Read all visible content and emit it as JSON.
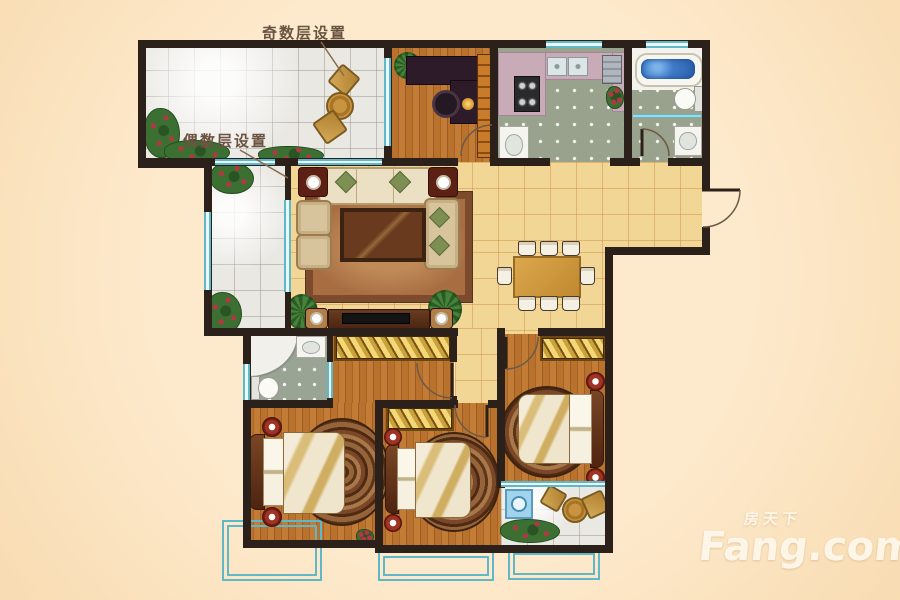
{
  "document": {
    "kind": "apartment-floor-plan",
    "width": 900,
    "height": 600
  },
  "annotations": {
    "odd_floor_note": "奇数层设置",
    "even_floor_note": "偶数层设置"
  },
  "watermark": {
    "brand_cn": "房天下",
    "brand_en": "Fang.com"
  },
  "palette": {
    "background": "#fbe4c2",
    "wall": "#2b211a",
    "window_teal": "#5fb7c8",
    "wood_floor": "#b8722e",
    "yellow_tile": "#f2d695",
    "white_tile": "#eae8e3",
    "gray_tile": "#99a28c",
    "wardrobe_gold": "#e0b24a",
    "counter_mauve": "#c9abb8",
    "tub_water": "#3f7cc8",
    "note_text": "#6b5342",
    "watermark": "#fdf4e0"
  },
  "legend": {
    "rooms": [
      "balcony-odd-floors-top-left",
      "study",
      "kitchen",
      "bathroom-main",
      "balcony-even-floors-left",
      "living-room",
      "dining-room",
      "entry",
      "bathroom-ensuite",
      "dressing-area",
      "master-bedroom",
      "middle-bedroom",
      "right-bedroom",
      "service-balcony"
    ],
    "furniture": [
      "wicker-chairs",
      "round-table",
      "desk",
      "office-chair",
      "bookshelf",
      "gas-stove",
      "kitchen-sinks",
      "fridge",
      "bathtub",
      "toilet",
      "basin",
      "sofa-set",
      "coffee-table",
      "area-rug",
      "tv-console",
      "dining-table",
      "dining-chairs",
      "corner-shower",
      "wardrobes",
      "double-beds",
      "bedside-tables",
      "round-rugs",
      "washing-machine",
      "plants",
      "bay-windows"
    ]
  }
}
